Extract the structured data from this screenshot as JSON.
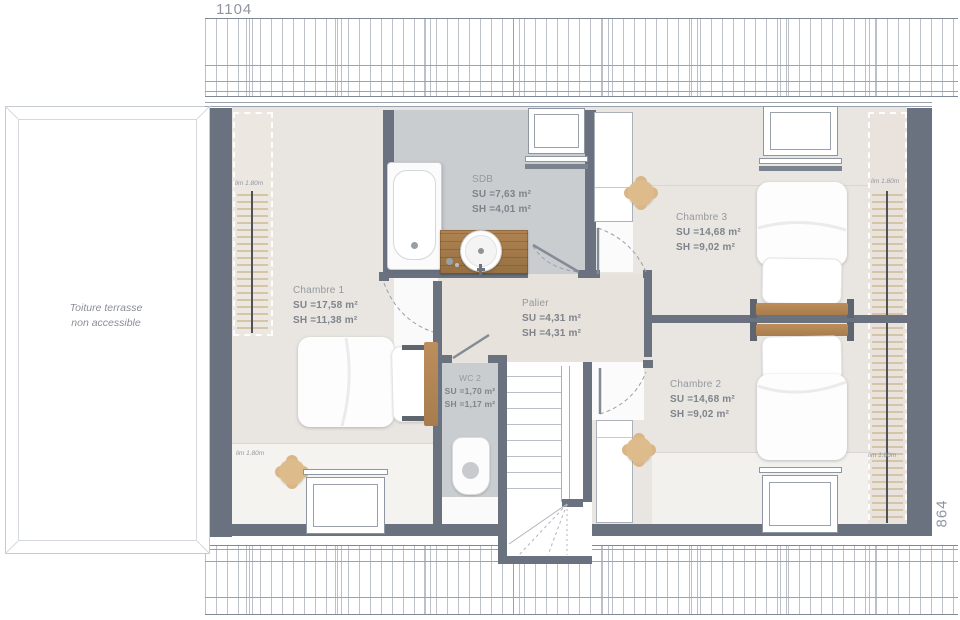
{
  "dimensions": {
    "top": "1104",
    "right": "864"
  },
  "terrace": {
    "line1": "Toiture terrasse",
    "line2": "non accessible"
  },
  "rooms": [
    {
      "id": "chambre1",
      "name": "Chambre 1",
      "su": "SU =17,58 m²",
      "sh": "SH =11,38 m²"
    },
    {
      "id": "sdb",
      "name": "SDB",
      "su": "SU =7,63 m²",
      "sh": "SH =4,01 m²"
    },
    {
      "id": "chambre3",
      "name": "Chambre 3",
      "su": "SU =14,68 m²",
      "sh": "SH =9,02 m²"
    },
    {
      "id": "palier",
      "name": "Palier",
      "su": "SU =4,31 m²",
      "sh": "SH =4,31 m²"
    },
    {
      "id": "wc2",
      "name": "WC 2",
      "su": "SU =1,70 m²",
      "sh": "SH =1,17 m²"
    },
    {
      "id": "chambre2",
      "name": "Chambre 2",
      "su": "SU =14,68 m²",
      "sh": "SH =9,02 m²"
    }
  ],
  "annotations": {
    "height_limit": "lim 1.80m"
  },
  "colors": {
    "wall": "#6a7280",
    "floor_bedroom": "#e9e6e1",
    "floor_wet": "#cacdd0",
    "floor_landing": "#e7e2db",
    "wood": "#ab7f4f",
    "furniture_tan": "#debb8b",
    "roof_line": "#7f8897"
  }
}
